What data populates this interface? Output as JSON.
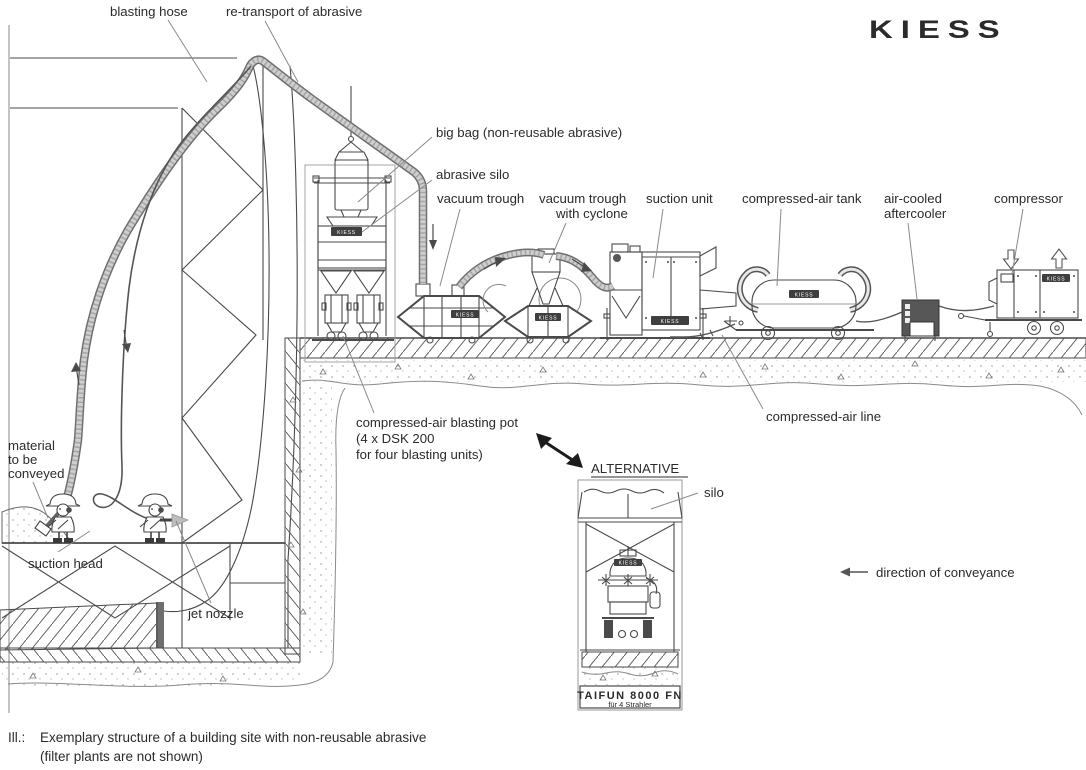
{
  "logo": {
    "brand": "KIESS"
  },
  "equipment_badge": "KIESS",
  "labels": {
    "blasting_hose": "blasting hose",
    "retransport": "re-transport of abrasive",
    "big_bag": "big bag (non-reusable abrasive)",
    "abrasive_silo": "abrasive silo",
    "vacuum_trough": "vacuum trough",
    "vacuum_trough_cyclone_1": "vacuum trough",
    "vacuum_trough_cyclone_2": "with cyclone",
    "suction_unit": "suction unit",
    "compressed_air_tank": "compressed-air tank",
    "aftercooler_1": "air-cooled",
    "aftercooler_2": "aftercooler",
    "compressor": "compressor",
    "material_1": "material",
    "material_2": "to be",
    "material_3": "conveyed",
    "suction_head": "suction head",
    "jet_nozzle": "jet nozzle",
    "blasting_pot_1": "compressed-air blasting pot",
    "blasting_pot_2": "(4 x DSK 200",
    "blasting_pot_3": "for four blasting units)",
    "compressed_air_line": "compressed-air line",
    "alternative": "ALTERNATIVE",
    "silo": "silo",
    "direction_of_conveyance": "direction of conveyance"
  },
  "alternative_unit": {
    "model": "TAIFUN 8000 FN",
    "subtitle": "für 4 Strahler"
  },
  "caption": {
    "prefix": "Ill.:",
    "line1": "Exemplary structure of a building site with non-reusable abrasive",
    "line2": "(filter plants are not shown)"
  },
  "colors": {
    "line": "#4a4a4a",
    "hose_fill": "#c9c9c9",
    "dark_fill": "#575757",
    "text": "#2b2b2b"
  }
}
